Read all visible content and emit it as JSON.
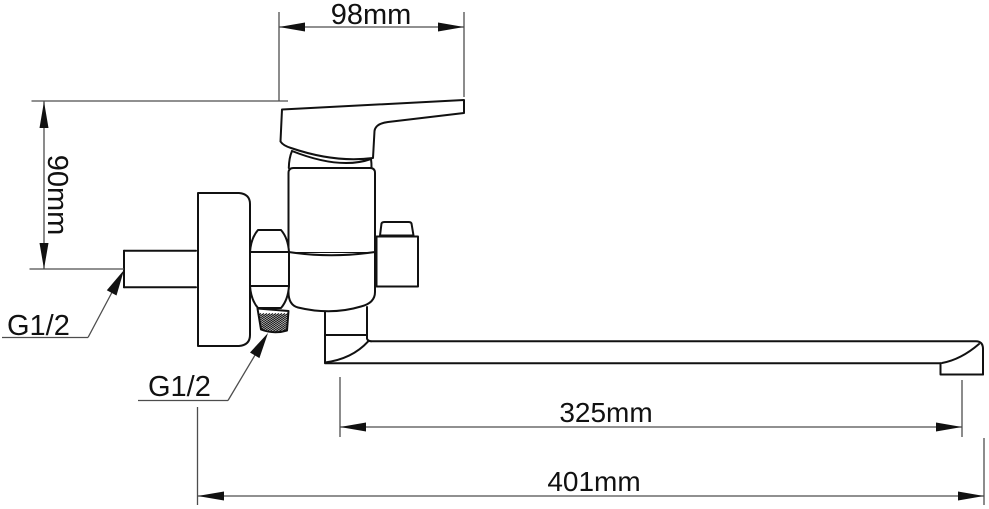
{
  "diagram": {
    "type": "technical-drawing",
    "subject": "Wall-mounted single-lever mixer faucet with long swivel spout, side view with dimensions",
    "background_color": "#ffffff",
    "line_color": "#111111",
    "dimension_line_color": "#4d4d4d",
    "dimensions": [
      {
        "id": "handle-length",
        "label": "98mm",
        "orientation": "horizontal",
        "position": "top"
      },
      {
        "id": "inlet-to-top-height",
        "label": "90mm",
        "orientation": "vertical",
        "position": "left"
      },
      {
        "id": "spout-length",
        "label": "325mm",
        "orientation": "horizontal",
        "position": "bottom"
      },
      {
        "id": "overall-length",
        "label": "401mm",
        "orientation": "horizontal",
        "position": "bottom"
      }
    ],
    "threads": [
      {
        "id": "wall-inlet-thread",
        "label": "G1/2"
      },
      {
        "id": "shower-outlet-thread",
        "label": "G1/2"
      }
    ]
  }
}
